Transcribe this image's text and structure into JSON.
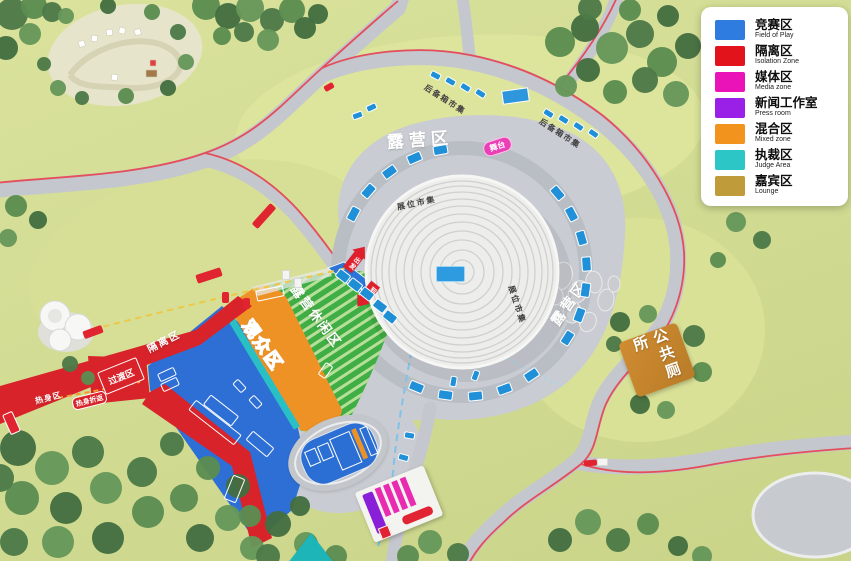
{
  "legend": {
    "items": [
      {
        "zh": "竞赛区",
        "en": "Field of Play",
        "color": "#2f7ce0"
      },
      {
        "zh": "隔离区",
        "en": "Isolation Zone",
        "color": "#e3131b"
      },
      {
        "zh": "媒体区",
        "en": "Media zone",
        "color": "#ea13b8"
      },
      {
        "zh": "新闻工作室",
        "en": "Press room",
        "color": "#9a20e8"
      },
      {
        "zh": "混合区",
        "en": "Mixed zone",
        "color": "#f2931d"
      },
      {
        "zh": "执裁区",
        "en": "Judge Area",
        "color": "#2cc6c6"
      },
      {
        "zh": "嘉宾区",
        "en": "Lounge",
        "color": "#bf9b3a"
      }
    ]
  },
  "map": {
    "camp_area": "露营区",
    "camp_area_side": "露营区",
    "stage": "舞台",
    "booth_market": "展位市集",
    "trunk_market": "后备箱市集",
    "leisure_area": "露营休闲区",
    "spectator_area": "观众区",
    "isolation_zone": "隔离区",
    "transition_zone": "过渡区",
    "warmup_zone": "热身区",
    "warmup_turnaround": "热身折返",
    "start_label": "出发",
    "finish_label": "到达",
    "public_toilet": "公共厕所"
  }
}
